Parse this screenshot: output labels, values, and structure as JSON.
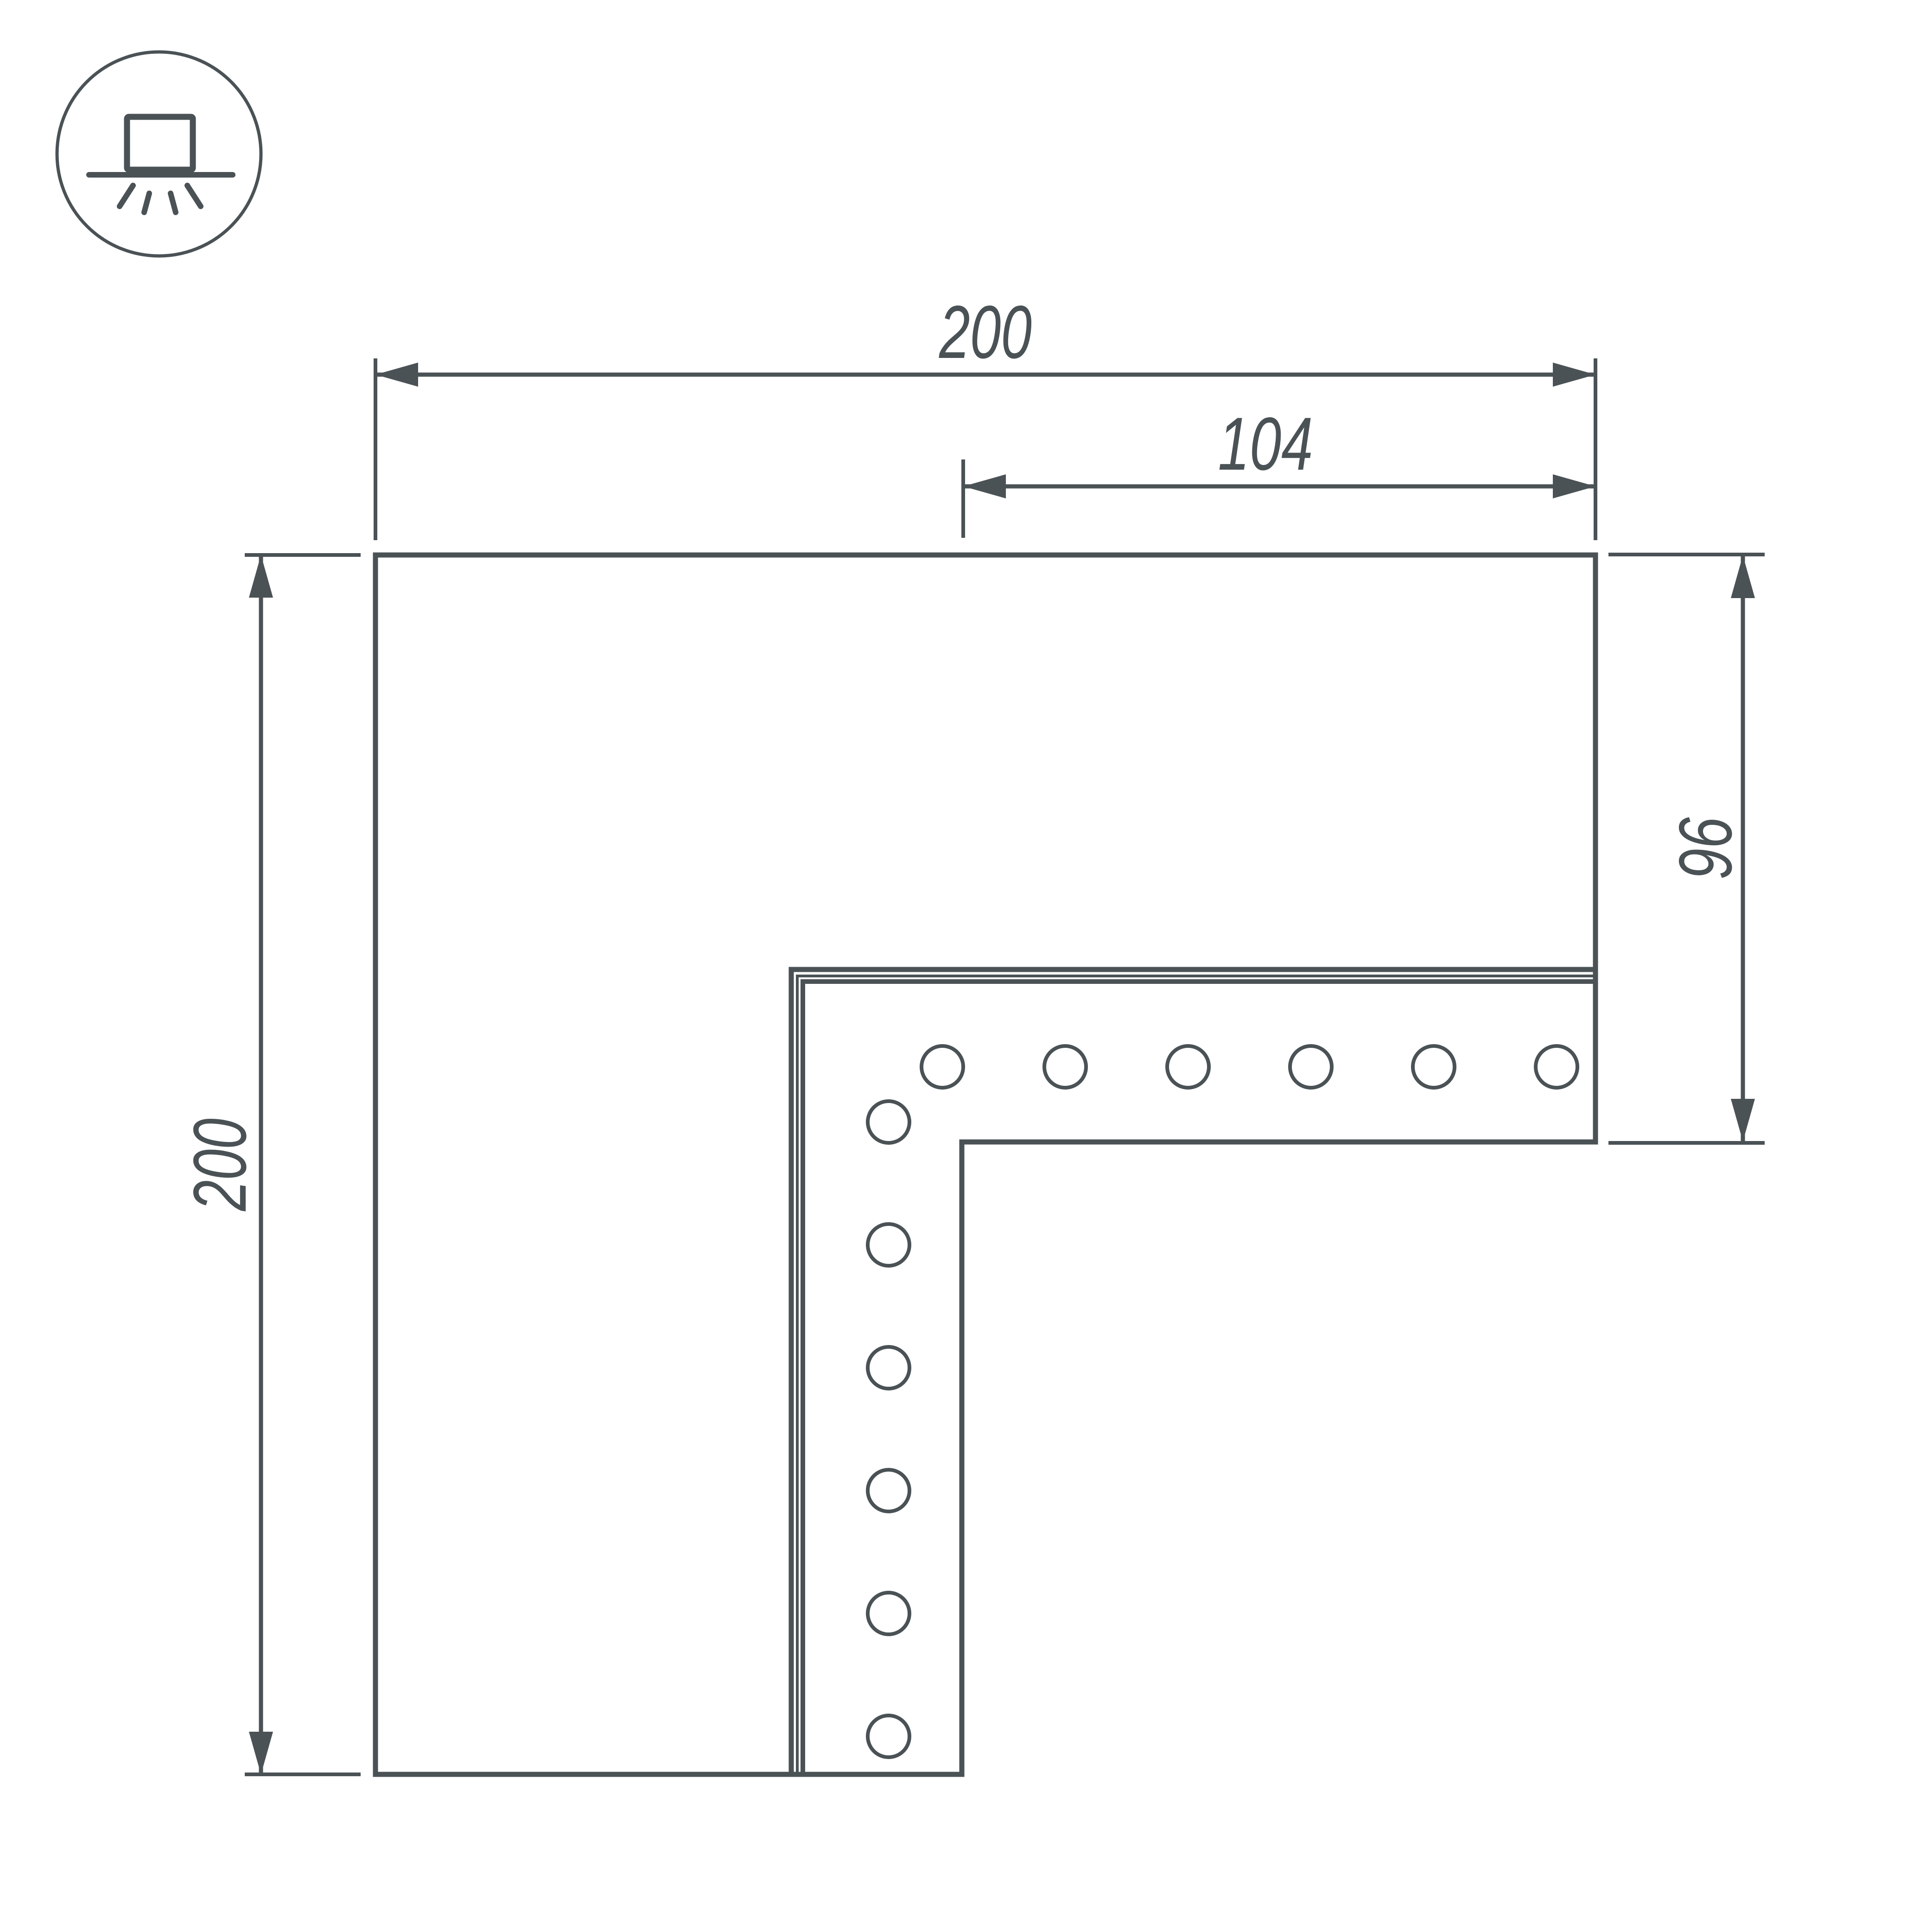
{
  "icon": {
    "name": "surface-mount-light-icon"
  },
  "dimensions": {
    "top_width": "200",
    "inner_width": "104",
    "right_height": "96",
    "left_height": "200"
  },
  "figure": {
    "type": "L-corner-connector-drawing",
    "hole_count_total": 12,
    "hole_count_row": 6,
    "hole_count_column": 6
  },
  "colors": {
    "line": "#4A5256",
    "background": "#FFFFFF"
  }
}
